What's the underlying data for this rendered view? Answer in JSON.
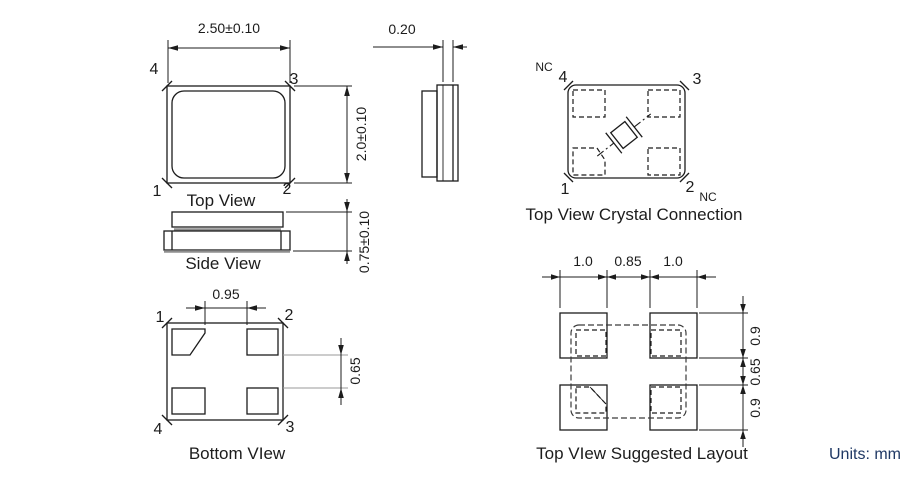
{
  "views": {
    "top_view": {
      "caption": "Top View",
      "width_dim": "2.50±0.10",
      "height_dim": "2.0±0.10",
      "pin_top_left": "4",
      "pin_top_right": "3",
      "pin_bottom_left": "1",
      "pin_bottom_right": "2"
    },
    "side_view": {
      "caption": "Side View",
      "height_dim": "0.75±0.10"
    },
    "end_view": {
      "lid_dim": "0.20"
    },
    "crystal_connection": {
      "caption": "Top View Crystal Connection",
      "pin_top_left": "4",
      "pin_top_right": "3",
      "pin_bottom_left": "1",
      "pin_bottom_right": "2",
      "nc_top_left": "NC",
      "nc_bottom_right": "NC"
    },
    "bottom_view": {
      "caption": "Bottom VIew",
      "pad_gap_dim": "0.95",
      "pad_gap_vertical_dim": "0.65",
      "pin_top_left": "1",
      "pin_top_right": "2",
      "pin_bottom_left": "4",
      "pin_bottom_right": "3"
    },
    "suggested_layout": {
      "caption": "Top VIew Suggested Layout",
      "horizontal_dims": [
        "1.0",
        "0.85",
        "1.0"
      ],
      "vertical_dims": [
        "0.9",
        "0.65",
        "0.9"
      ]
    }
  },
  "units_note": "Units: mm",
  "colors": {
    "line": "#1c1c1c",
    "gray_line": "#8f8f8f",
    "units_text": "#1f3864"
  }
}
